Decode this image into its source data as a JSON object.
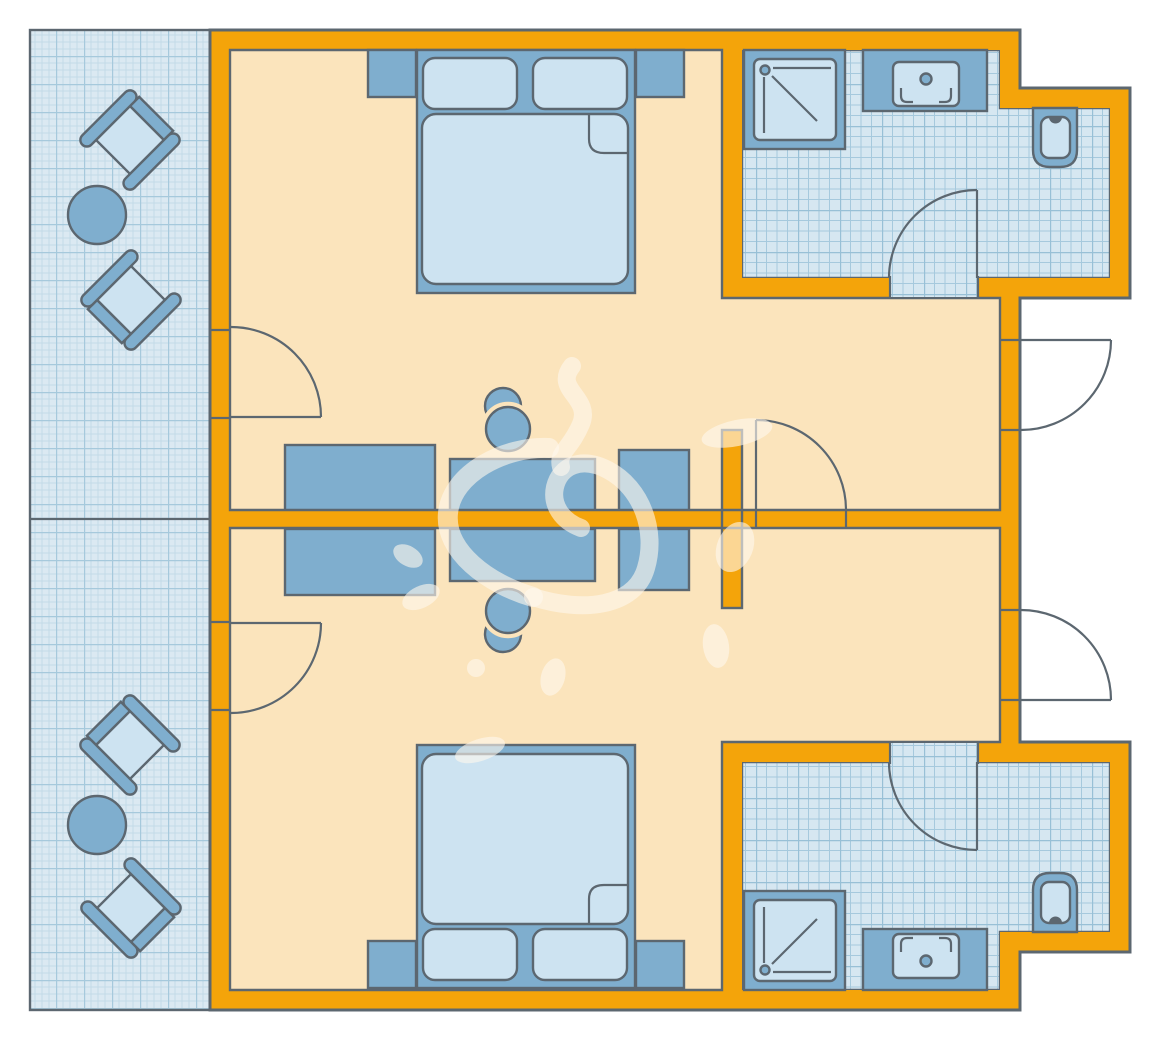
{
  "page": {
    "background": "#FFFFFF"
  },
  "colors": {
    "bg": "#FFFFFF",
    "wall": "#F4A40A",
    "line": "#5C6770",
    "floor": "#FBE4BC",
    "balcony_base": "#DBE9F2",
    "grid_fine": "#C3DAE8",
    "grid_strong": "#A6C9DC",
    "bath_base": "#D6E7F1",
    "bath_grid": "#A6C9DD",
    "bath_grid_strong": "#98C0D6",
    "blue_mid": "#7FAECE",
    "blue_light": "#CDE3F1",
    "wm": "rgba(255,249,238,0.6)"
  },
  "plan": {
    "type": "hotel-suite-floor-plan",
    "areas": [
      "balcony-top",
      "balcony-bottom",
      "bedroom-top",
      "bedroom-bottom",
      "bathroom-top",
      "bathroom-bottom"
    ],
    "furniture_counts": {
      "double_beds": 2,
      "nightstands": 4,
      "balcony_chairs": 4,
      "balcony_tables": 2,
      "dressers": 2,
      "desks": 2,
      "desk_chairs": 2,
      "tv_stands": 2,
      "showers": 2,
      "sinks": 2,
      "toilets": 2,
      "doors": 7
    }
  }
}
